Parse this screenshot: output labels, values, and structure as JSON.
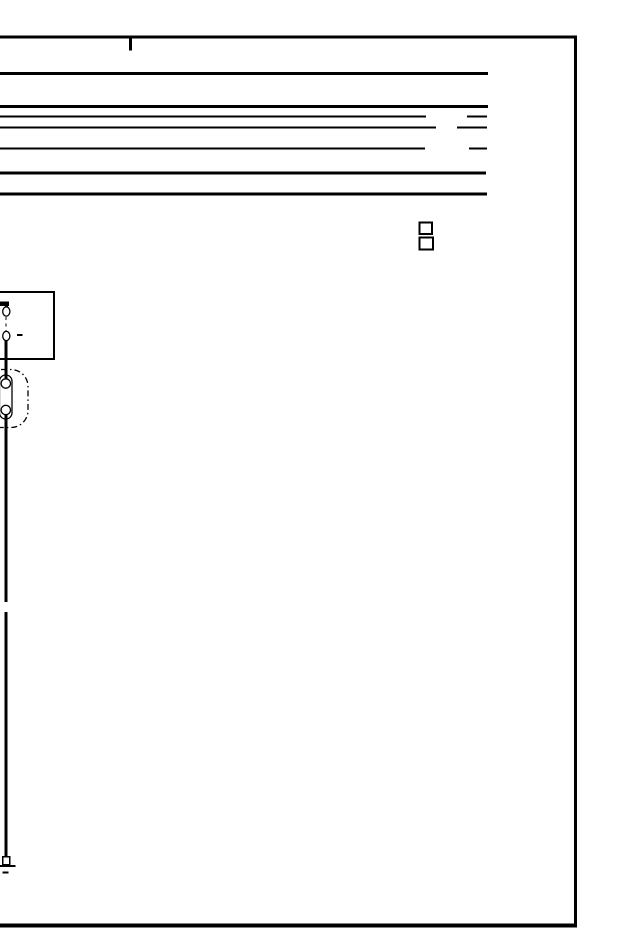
{
  "meta": {
    "background": "#ffffff",
    "ink": "#000000",
    "description": "Black-and-white wiring-diagram page fragment: ruled header block, two small squares, component box with connector pins, inline connector with two terminals, single wire running down to a ground symbol"
  },
  "diagram": {
    "width": 640,
    "height": 950,
    "elements": [
      {
        "name": "page-top-border",
        "type": "line",
        "x1": 0,
        "y1": 37,
        "x2": 577,
        "y2": 37,
        "sw": 3.4
      },
      {
        "name": "page-right-border",
        "type": "line",
        "x1": 575.5,
        "y1": 35.5,
        "x2": 575.5,
        "y2": 927,
        "sw": 3.4
      },
      {
        "name": "page-bottom-border",
        "type": "line",
        "x1": 0,
        "y1": 925.5,
        "x2": 577,
        "y2": 925.5,
        "sw": 4
      },
      {
        "name": "top-margin-tick",
        "type": "line",
        "x1": 130.5,
        "y1": 38.5,
        "x2": 130.5,
        "y2": 50.5,
        "sw": 3
      },
      {
        "name": "header-rule-1",
        "type": "line",
        "x1": 0,
        "y1": 73.5,
        "x2": 488,
        "y2": 73.5,
        "sw": 3
      },
      {
        "name": "header-rule-2",
        "type": "line",
        "x1": 0,
        "y1": 106.5,
        "x2": 488,
        "y2": 106.5,
        "sw": 3
      },
      {
        "name": "header-rule-3-left",
        "type": "line",
        "x1": 0,
        "y1": 116.5,
        "x2": 426,
        "y2": 116.5,
        "sw": 2.2
      },
      {
        "name": "header-rule-3-right",
        "type": "line",
        "x1": 467,
        "y1": 116.5,
        "x2": 487,
        "y2": 116.5,
        "sw": 2.2
      },
      {
        "name": "header-rule-4-left",
        "type": "line",
        "x1": 0,
        "y1": 127.5,
        "x2": 436,
        "y2": 127.5,
        "sw": 2.2
      },
      {
        "name": "header-rule-4-right",
        "type": "line",
        "x1": 457,
        "y1": 127.5,
        "x2": 487,
        "y2": 127.5,
        "sw": 2.2
      },
      {
        "name": "header-rule-5-left",
        "type": "line",
        "x1": 0,
        "y1": 148.5,
        "x2": 425,
        "y2": 148.5,
        "sw": 2.2
      },
      {
        "name": "header-rule-5-right",
        "type": "line",
        "x1": 469,
        "y1": 148.5,
        "x2": 487,
        "y2": 148.5,
        "sw": 2.2
      },
      {
        "name": "header-rule-6",
        "type": "line",
        "x1": 0,
        "y1": 173,
        "x2": 486,
        "y2": 173,
        "sw": 3
      },
      {
        "name": "header-rule-7",
        "type": "line",
        "x1": 0,
        "y1": 194,
        "x2": 487,
        "y2": 194,
        "sw": 3
      },
      {
        "name": "small-square-top",
        "type": "rect",
        "x": 419.5,
        "y": 222.5,
        "w": 12.5,
        "h": 11.5,
        "sw": 2
      },
      {
        "name": "small-square-bottom",
        "type": "rect",
        "x": 419.5,
        "y": 237.5,
        "w": 13.5,
        "h": 12,
        "sw": 2
      },
      {
        "name": "component-box",
        "type": "rect",
        "x": -20,
        "y": 292,
        "w": 74,
        "h": 67,
        "sw": 1.8
      },
      {
        "name": "wire-stub-horizontal",
        "type": "line",
        "x1": 0,
        "y1": 303.5,
        "x2": 9,
        "y2": 303.5,
        "sw": 4.5
      },
      {
        "name": "wire-stub-drop",
        "type": "line",
        "x1": 6.3,
        "y1": 303.5,
        "x2": 6.3,
        "y2": 308,
        "sw": 3
      },
      {
        "name": "wire-upper",
        "type": "line",
        "x1": 6,
        "y1": 338,
        "x2": 6,
        "y2": 381,
        "sw": 3.2
      },
      {
        "name": "wire-middle",
        "type": "line",
        "x1": 6,
        "y1": 408,
        "x2": 6,
        "y2": 602,
        "sw": 3.2
      },
      {
        "name": "wire-lower",
        "type": "line",
        "x1": 6,
        "y1": 612,
        "x2": 6,
        "y2": 858,
        "sw": 3.2
      },
      {
        "name": "connector-dashed-outline",
        "type": "rect",
        "x": -16,
        "y": 369.5,
        "w": 44,
        "h": 58,
        "rx": 17,
        "sw": 1.3,
        "dash": "6,3,1.5,3"
      },
      {
        "name": "terminal-stadium",
        "type": "rect",
        "x": -0.5,
        "y": 375,
        "w": 12.5,
        "h": 44,
        "rx": 6.2,
        "sw": 1.3
      },
      {
        "name": "pin-gap-dashed-link",
        "type": "line",
        "x1": 6,
        "y1": 317,
        "x2": 6,
        "y2": 331,
        "sw": 1.3,
        "dash": "3,3.5"
      },
      {
        "name": "pin-terminal-top",
        "type": "ellipse",
        "cx": 6.3,
        "cy": 311.5,
        "rx": 3.6,
        "ry": 4.6,
        "sw": 1.3,
        "fill": "#ffffff"
      },
      {
        "name": "pin-terminal-bottom",
        "type": "ellipse",
        "cx": 6.3,
        "cy": 336,
        "rx": 3.6,
        "ry": 4.6,
        "sw": 1.3,
        "fill": "#ffffff"
      },
      {
        "name": "pin-side-dash",
        "type": "line",
        "x1": 17,
        "y1": 335,
        "x2": 22.5,
        "y2": 335,
        "sw": 2
      },
      {
        "name": "connector-terminal-top",
        "type": "circle",
        "cx": 5.8,
        "cy": 383.5,
        "r": 4.7,
        "sw": 1.3,
        "fill": "#ffffff"
      },
      {
        "name": "connector-terminal-bottom",
        "type": "circle",
        "cx": 5.8,
        "cy": 410,
        "r": 4.7,
        "sw": 1.3,
        "fill": "#ffffff"
      },
      {
        "name": "ground-terminal-square",
        "type": "rect",
        "x": 2.8,
        "y": 856.5,
        "w": 7,
        "h": 8,
        "sw": 1.5,
        "fill": "#ffffff"
      },
      {
        "name": "ground-bar-long",
        "type": "line",
        "x1": 0,
        "y1": 866,
        "x2": 15.5,
        "y2": 866,
        "sw": 1.8
      },
      {
        "name": "ground-bar-short",
        "type": "line",
        "x1": 2.5,
        "y1": 872.5,
        "x2": 8.5,
        "y2": 872.5,
        "sw": 1.8
      }
    ]
  }
}
